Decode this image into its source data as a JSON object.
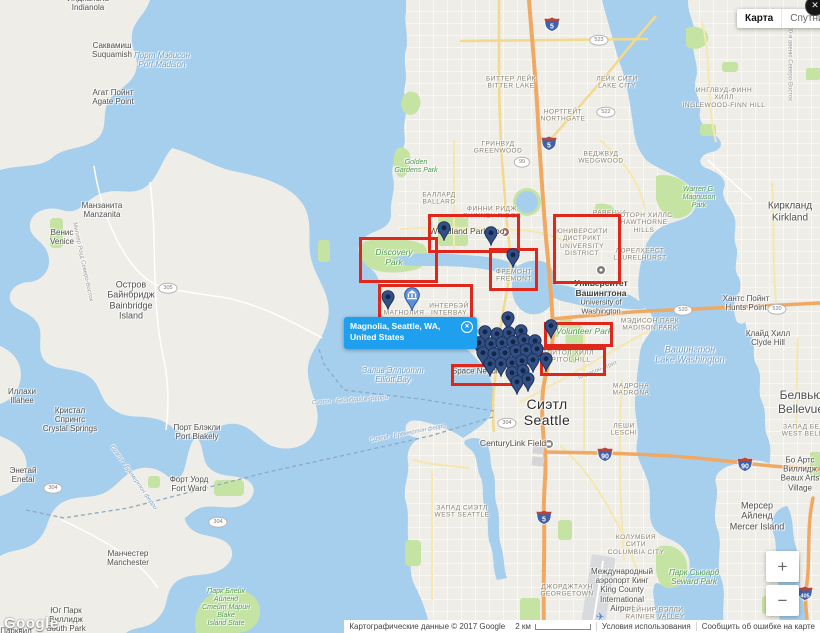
{
  "header": {
    "map_button": "Карта",
    "satellite_button": "Спутник",
    "close": "✕"
  },
  "info_window": {
    "lines": [
      "Magnolia, Seattle, WA,",
      "United States"
    ],
    "close": "✕"
  },
  "controls": {
    "zoom_in": "+",
    "zoom_out": "−"
  },
  "footer": {
    "logo": "Google",
    "copyright": "Картографические данные © 2017 Google",
    "scale_label": "2 км",
    "terms": "Условия использования",
    "report": "Сообщить об ошибке на карте"
  },
  "colors": {
    "accent_red": "#e0271c",
    "info_blue": "#1fa0ef",
    "marker_blue": "#335086",
    "water": "#a6cfee",
    "land": "#eeede7",
    "park": "#c5e3a2",
    "motorway": "#f0a862"
  },
  "map": {
    "labels": [
      {
        "t": [
          "Индианола",
          "Indianola"
        ],
        "x": 88,
        "y": 3,
        "c": "town"
      },
      {
        "t": [
          "Саквамиш",
          "Suquamish"
        ],
        "x": 112,
        "y": 50,
        "c": "town"
      },
      {
        "t": [
          "Порт Мэдисон",
          "Port Madison"
        ],
        "x": 162,
        "y": 60,
        "c": "water"
      },
      {
        "t": [
          "Агат Пойнт",
          "Agate Point"
        ],
        "x": 113,
        "y": 97,
        "c": "town"
      },
      {
        "t": [
          "Манзанита",
          "Manzanita"
        ],
        "x": 102,
        "y": 210,
        "c": "town"
      },
      {
        "t": [
          "Венис",
          "Venice"
        ],
        "x": 62,
        "y": 237,
        "c": "town"
      },
      {
        "t": [
          "Остров",
          "Байнбридж",
          "Bainbridge",
          "Island"
        ],
        "x": 131,
        "y": 300,
        "c": "town",
        "s": 9
      },
      {
        "t": [
          "Иллахи",
          "Illahee"
        ],
        "x": 22,
        "y": 396,
        "c": "town"
      },
      {
        "t": [
          "Кристал",
          "Спрингс",
          "Crystal Springs"
        ],
        "x": 70,
        "y": 420,
        "c": "town"
      },
      {
        "t": [
          "Порт Блэкли",
          "Port Blakely"
        ],
        "x": 197,
        "y": 432,
        "c": "town"
      },
      {
        "t": [
          "Форт Уорд",
          "Fort Ward"
        ],
        "x": 189,
        "y": 484,
        "c": "town"
      },
      {
        "t": [
          "Энетай",
          "Enetai"
        ],
        "x": 23,
        "y": 475,
        "c": "town"
      },
      {
        "t": [
          "Манчестер",
          "Manchester"
        ],
        "x": 128,
        "y": 558,
        "c": "town"
      },
      {
        "t": [
          "Юг Парк",
          "Виллидж",
          "South Park"
        ],
        "x": 66,
        "y": 620,
        "c": "town"
      },
      {
        "t": [
          "Парквил"
        ],
        "x": 16,
        "y": 631,
        "c": "town"
      },
      {
        "t": [
          "Киркланд",
          "Kirkland"
        ],
        "x": 790,
        "y": 212,
        "c": "town",
        "s": 10
      },
      {
        "t": [
          "Хантс Пойнт",
          "Hunts Point"
        ],
        "x": 746,
        "y": 303,
        "c": "town"
      },
      {
        "t": [
          "Клайд Хилл",
          "Clyde Hill"
        ],
        "x": 768,
        "y": 338,
        "c": "town"
      },
      {
        "t": [
          "Белвью",
          "Bellevue"
        ],
        "x": 801,
        "y": 403,
        "c": "town",
        "s": 12
      },
      {
        "t": [
          "Бо Артс",
          "Виллидж",
          "Beaux Arts",
          "Village"
        ],
        "x": 800,
        "y": 474,
        "c": "town"
      },
      {
        "t": [
          "Мерсер",
          "Айленд",
          "Mercer Island"
        ],
        "x": 757,
        "y": 516,
        "c": "town",
        "s": 9
      },
      {
        "t": [
          "Международный",
          "аэропорт Кинг",
          "King County",
          "International",
          "Airport"
        ],
        "x": 622,
        "y": 590,
        "c": "town"
      },
      {
        "t": [
          "Сиэтл",
          "Seattle"
        ],
        "x": 547,
        "y": 412,
        "c": "city"
      },
      {
        "t": [
          "Залив Эллиотт",
          "Elliott Bay"
        ],
        "x": 393,
        "y": 375,
        "c": "water"
      },
      {
        "t": [
          "Вашингтон",
          "Lake Washington"
        ],
        "x": 690,
        "y": 355,
        "c": "water",
        "s": 9
      },
      {
        "t": [
          "Сиэтл - Бейнбридж-ферри"
        ],
        "x": 350,
        "y": 401,
        "c": "ferry",
        "r": -4
      },
      {
        "t": [
          "Сиэтл - Бремертон ферри"
        ],
        "x": 408,
        "y": 434,
        "c": "ferry",
        "r": -11
      },
      {
        "t": [
          "Сиэтл - Бремертон ферри"
        ],
        "x": 133,
        "y": 478,
        "c": "ferry",
        "r": 55
      },
      {
        "t": [
          "Golden",
          "Gardens Park"
        ],
        "x": 416,
        "y": 167,
        "c": "park"
      },
      {
        "t": [
          "Discovery",
          "Park"
        ],
        "x": 394,
        "y": 258,
        "c": "park",
        "s": 8.5
      },
      {
        "t": [
          "Warren G.",
          "Magnuson",
          "Park"
        ],
        "x": 699,
        "y": 198,
        "c": "park"
      },
      {
        "t": [
          "Volunteer Park"
        ],
        "x": 584,
        "y": 332,
        "c": "park",
        "s": 8.5
      },
      {
        "t": [
          "Парк Сьюард",
          "Seward Park"
        ],
        "x": 694,
        "y": 577,
        "c": "park",
        "s": 8
      },
      {
        "t": [
          "Парк Блейк",
          "Айленд",
          "Стейт Марин",
          "Blake",
          "Island State"
        ],
        "x": 226,
        "y": 608,
        "c": "park"
      },
      {
        "t": [
          "БИТТЕР ЛЕЙК",
          "BITTER LAKE"
        ],
        "x": 511,
        "y": 83,
        "c": "district"
      },
      {
        "t": [
          "ЛЕЙК СИТИ",
          "LAKE CITY"
        ],
        "x": 617,
        "y": 83,
        "c": "district"
      },
      {
        "t": [
          "НОРТГЕЙТ",
          "NORTHGATE"
        ],
        "x": 563,
        "y": 116,
        "c": "district"
      },
      {
        "t": [
          "ГРИНВУД",
          "GREENWOOD"
        ],
        "x": 498,
        "y": 148,
        "c": "district"
      },
      {
        "t": [
          "ИНГЛВУД-ФИНН",
          "ХИЛЛ",
          "INGLEWOOD-FINN HILL"
        ],
        "x": 724,
        "y": 98,
        "c": "district"
      },
      {
        "t": [
          "ВЕДЖВУД",
          "WEDGWOOD"
        ],
        "x": 601,
        "y": 158,
        "c": "district"
      },
      {
        "t": [
          "РАВЕННА"
        ],
        "x": 610,
        "y": 213,
        "c": "district"
      },
      {
        "t": [
          "ХОТОРН ХИЛЛС",
          "HAWTHORNE",
          "HILLS"
        ],
        "x": 644,
        "y": 223,
        "c": "district"
      },
      {
        "t": [
          "ЛОРЕЛХЕРСТ",
          "LAURELHURST"
        ],
        "x": 640,
        "y": 255,
        "c": "district"
      },
      {
        "t": [
          "БАЛЛАРД",
          "BALLARD"
        ],
        "x": 439,
        "y": 199,
        "c": "district"
      },
      {
        "t": [
          "ФИННИ РИДЖ",
          "PHINNEY RIDGE"
        ],
        "x": 492,
        "y": 213,
        "c": "district"
      },
      {
        "t": [
          "ЮНИВЕРСИТИ",
          "ДИСТРИКТ",
          "UNIVERSITY",
          "DISTRICT"
        ],
        "x": 582,
        "y": 243,
        "c": "district"
      },
      {
        "t": [
          "ФРЕМОНТ",
          "FREMONT"
        ],
        "x": 514,
        "y": 276,
        "c": "district"
      },
      {
        "t": [
          "МАГНОЛИЯ"
        ],
        "x": 404,
        "y": 313,
        "c": "district"
      },
      {
        "t": [
          "ИНТЕРБЭЙ",
          "INTERBAY"
        ],
        "x": 449,
        "y": 310,
        "c": "district"
      },
      {
        "t": [
          "КВИН-ЭНН",
          "QUEEN ANNE"
        ],
        "x": 494,
        "y": 336,
        "c": "district"
      },
      {
        "t": [
          "КАПИТОЛ ХИЛЛ",
          "CAPITOL HILL"
        ],
        "x": 566,
        "y": 357,
        "c": "district"
      },
      {
        "t": [
          "МЭДИСОН ПАРК",
          "MADISON PARK"
        ],
        "x": 650,
        "y": 325,
        "c": "district"
      },
      {
        "t": [
          "МАДРОНА",
          "MADRONA"
        ],
        "x": 631,
        "y": 390,
        "c": "district"
      },
      {
        "t": [
          "ЛЕШИ",
          "LESCHI"
        ],
        "x": 624,
        "y": 430,
        "c": "district"
      },
      {
        "t": [
          "ЗАПАД СИЭТЛ",
          "WEST SEATTLE"
        ],
        "x": 462,
        "y": 512,
        "c": "district"
      },
      {
        "t": [
          "КОЛУМБИЯ",
          "СИТИ",
          "COLUMBIA CITY"
        ],
        "x": 636,
        "y": 545,
        "c": "district"
      },
      {
        "t": [
          "РЕЙНИР ВЭЛЛИ",
          "RAINIER VALLEY"
        ],
        "x": 655,
        "y": 614,
        "c": "district"
      },
      {
        "t": [
          "ДЖОРДЖТАУН",
          "GEORGETOWN"
        ],
        "x": 567,
        "y": 591,
        "c": "district"
      },
      {
        "t": [
          "ЗАПАД БЕЛВЬЮ",
          "WEST BELLEVUE"
        ],
        "x": 812,
        "y": 431,
        "c": "district"
      },
      {
        "t": [
          "Woodland Park Zoo"
        ],
        "x": 467,
        "y": 232,
        "c": "poi",
        "s": 8.5
      },
      {
        "t": [
          "Университет",
          "Вашингтона"
        ],
        "x": 601,
        "y": 289,
        "c": "poiStrong"
      },
      {
        "t": [
          "University of",
          "Washington"
        ],
        "x": 601,
        "y": 307,
        "c": "poi"
      },
      {
        "t": [
          "CenturyLink Field"
        ],
        "x": 513,
        "y": 444,
        "c": "poi",
        "s": 8.5
      },
      {
        "t": [
          "Space Needle"
        ],
        "x": 477,
        "y": 371,
        "c": "poi",
        "s": 8
      },
      {
        "t": [
          "100-я авеню Северо-Восток"
        ],
        "x": 789,
        "y": 62,
        "c": "street",
        "r": 90
      },
      {
        "t": [
          "Миллер Роуд Северо-Восток"
        ],
        "x": 82,
        "y": 262,
        "c": "street",
        "r": 78
      },
      {
        "t": [
          "Мэдисон-стрит"
        ],
        "x": 598,
        "y": 371,
        "c": "street",
        "r": -22
      }
    ],
    "highlight_boxes": [
      {
        "x": 428,
        "y": 214,
        "w": 86,
        "h": 33
      },
      {
        "x": 359,
        "y": 237,
        "w": 73,
        "h": 40
      },
      {
        "x": 553,
        "y": 214,
        "w": 62,
        "h": 64
      },
      {
        "x": 489,
        "y": 248,
        "w": 43,
        "h": 37
      },
      {
        "x": 378,
        "y": 284,
        "w": 89,
        "h": 33
      },
      {
        "x": 544,
        "y": 322,
        "w": 63,
        "h": 19
      },
      {
        "x": 540,
        "y": 347,
        "w": 60,
        "h": 23
      },
      {
        "x": 451,
        "y": 364,
        "w": 63,
        "h": 16
      }
    ],
    "markers": {
      "pins": [
        [
          444,
          241
        ],
        [
          491,
          246
        ],
        [
          513,
          268
        ],
        [
          388,
          310
        ],
        [
          551,
          339
        ],
        [
          508,
          331
        ],
        [
          485,
          345
        ],
        [
          497,
          347
        ],
        [
          509,
          346
        ],
        [
          521,
          344
        ],
        [
          479,
          356
        ],
        [
          491,
          357
        ],
        [
          502,
          356
        ],
        [
          513,
          355
        ],
        [
          524,
          353
        ],
        [
          535,
          354
        ],
        [
          483,
          366
        ],
        [
          494,
          367
        ],
        [
          505,
          366
        ],
        [
          516,
          364
        ],
        [
          526,
          363
        ],
        [
          537,
          362
        ],
        [
          546,
          372
        ],
        [
          490,
          377
        ],
        [
          501,
          377
        ],
        [
          512,
          376
        ],
        [
          522,
          374
        ],
        [
          533,
          373
        ],
        [
          512,
          386
        ],
        [
          523,
          384
        ],
        [
          517,
          395
        ],
        [
          528,
          392
        ]
      ],
      "museum_pin": [
        412,
        311
      ]
    },
    "shields": [
      {
        "k": "i",
        "n": "5",
        "x": 552,
        "y": 27
      },
      {
        "k": "i",
        "n": "5",
        "x": 549,
        "y": 146
      },
      {
        "k": "i",
        "n": "5",
        "x": 544,
        "y": 520
      },
      {
        "k": "i",
        "n": "90",
        "x": 605,
        "y": 457
      },
      {
        "k": "i",
        "n": "90",
        "x": 745,
        "y": 467
      },
      {
        "k": "i",
        "n": "405",
        "x": 805,
        "y": 596
      },
      {
        "k": "o",
        "n": "99",
        "x": 522,
        "y": 162
      },
      {
        "k": "o",
        "n": "522",
        "x": 606,
        "y": 112
      },
      {
        "k": "o",
        "n": "523",
        "x": 599,
        "y": 40
      },
      {
        "k": "o",
        "n": "305",
        "x": 168,
        "y": 288
      },
      {
        "k": "o",
        "n": "304",
        "x": 53,
        "y": 488
      },
      {
        "k": "o",
        "n": "304",
        "x": 218,
        "y": 522
      },
      {
        "k": "o",
        "n": "304",
        "x": 507,
        "y": 423
      },
      {
        "k": "o",
        "n": "520",
        "x": 683,
        "y": 310
      },
      {
        "k": "o",
        "n": "520",
        "x": 777,
        "y": 309
      }
    ]
  }
}
